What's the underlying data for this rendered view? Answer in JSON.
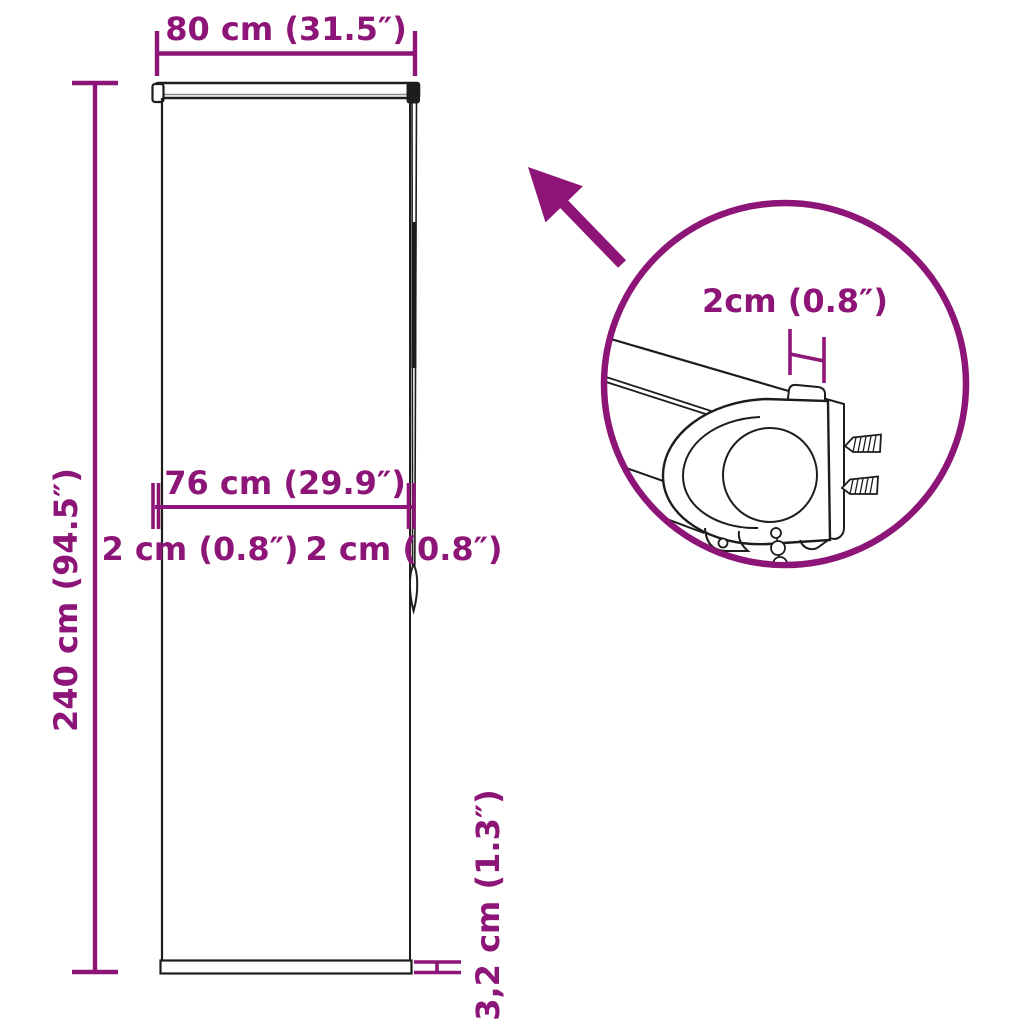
{
  "meta": {
    "title": "Roller blind dimension diagram"
  },
  "colors": {
    "accent": "#8E1578",
    "ink": "#1d1d1b",
    "background": "#ffffff"
  },
  "labels": {
    "total_width": "80 cm (31.5″)",
    "total_height": "240 cm (94.5″)",
    "fabric_width": "76 cm (29.9″)",
    "offset_left": "2 cm (0.8″)",
    "offset_right": "2 cm (0.8″)",
    "bottom_bar": "3,2 cm (1.3″)",
    "detail_gap": "2cm (0.8″)"
  }
}
